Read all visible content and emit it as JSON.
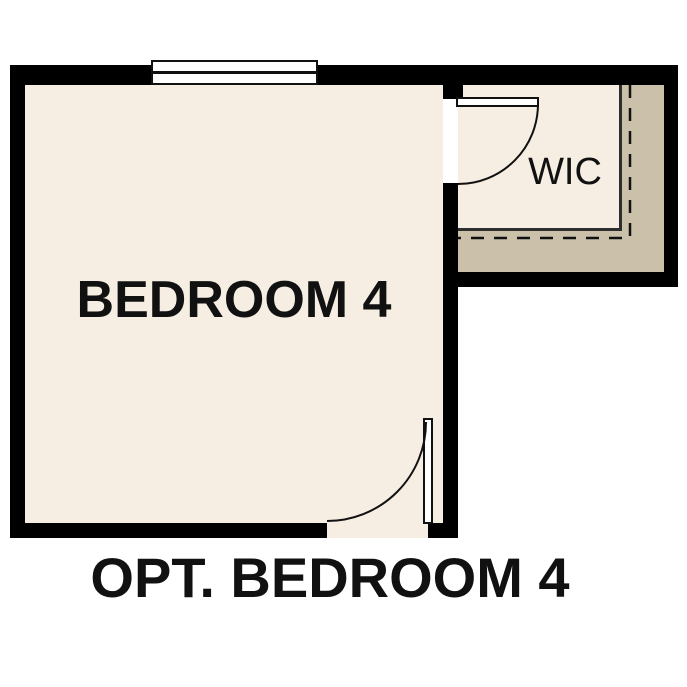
{
  "plan": {
    "room_label": "BEDROOM 4",
    "closet_label": "WIC",
    "caption": "OPT. BEDROOM 4"
  },
  "colors": {
    "floor": "#f6eee2",
    "closet_depth_band": "#cbc0aa",
    "wall": "#000000",
    "line": "#111111",
    "background": "#ffffff",
    "text": "#111111"
  },
  "features": {
    "window": "window-symbol-top-wall",
    "wic_door": "door-swing-arc",
    "entry_door": "door-swing-arc",
    "dashed_boundary": "optional-area-dashed-line"
  }
}
